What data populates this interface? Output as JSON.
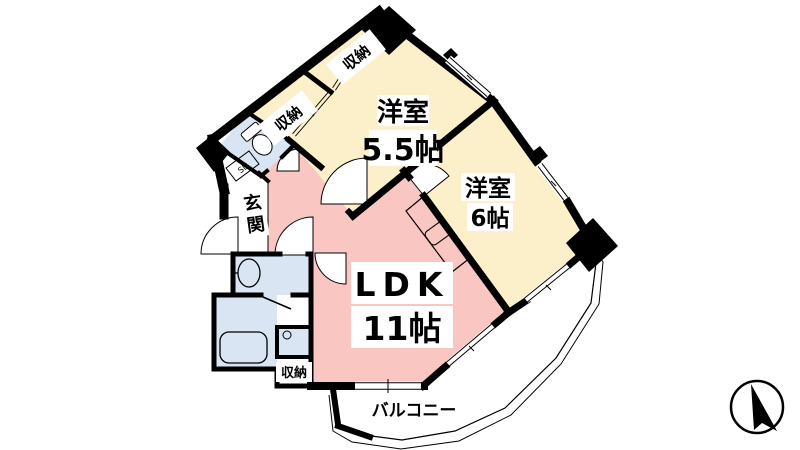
{
  "plan": {
    "type": "floor-plan",
    "labels": {
      "closet_top": "収納",
      "closet_mid": "収納",
      "closet_bottom": "収納",
      "room_55_name": "洋室",
      "room_55_size": "5.5帖",
      "room_6_name": "洋室",
      "room_6_size": "6帖",
      "ldk_name": "LDK",
      "ldk_size": "11帖",
      "balcony": "バルコニー",
      "entrance_char1": "玄",
      "entrance_char2": "関",
      "shoe_box": "SB"
    },
    "colors": {
      "room_cream": "#fcf0cb",
      "ldk_pink": "#f9c6c2",
      "wet_area_blue": "#d9e5f3",
      "entrance_gray": "#cccccc",
      "balcony_gray": "#d6d6d6",
      "shoebox_tan": "#ece0c2",
      "wall": "#000000",
      "background": "#ffffff"
    },
    "icons": {
      "compass": "north-arrow"
    }
  }
}
